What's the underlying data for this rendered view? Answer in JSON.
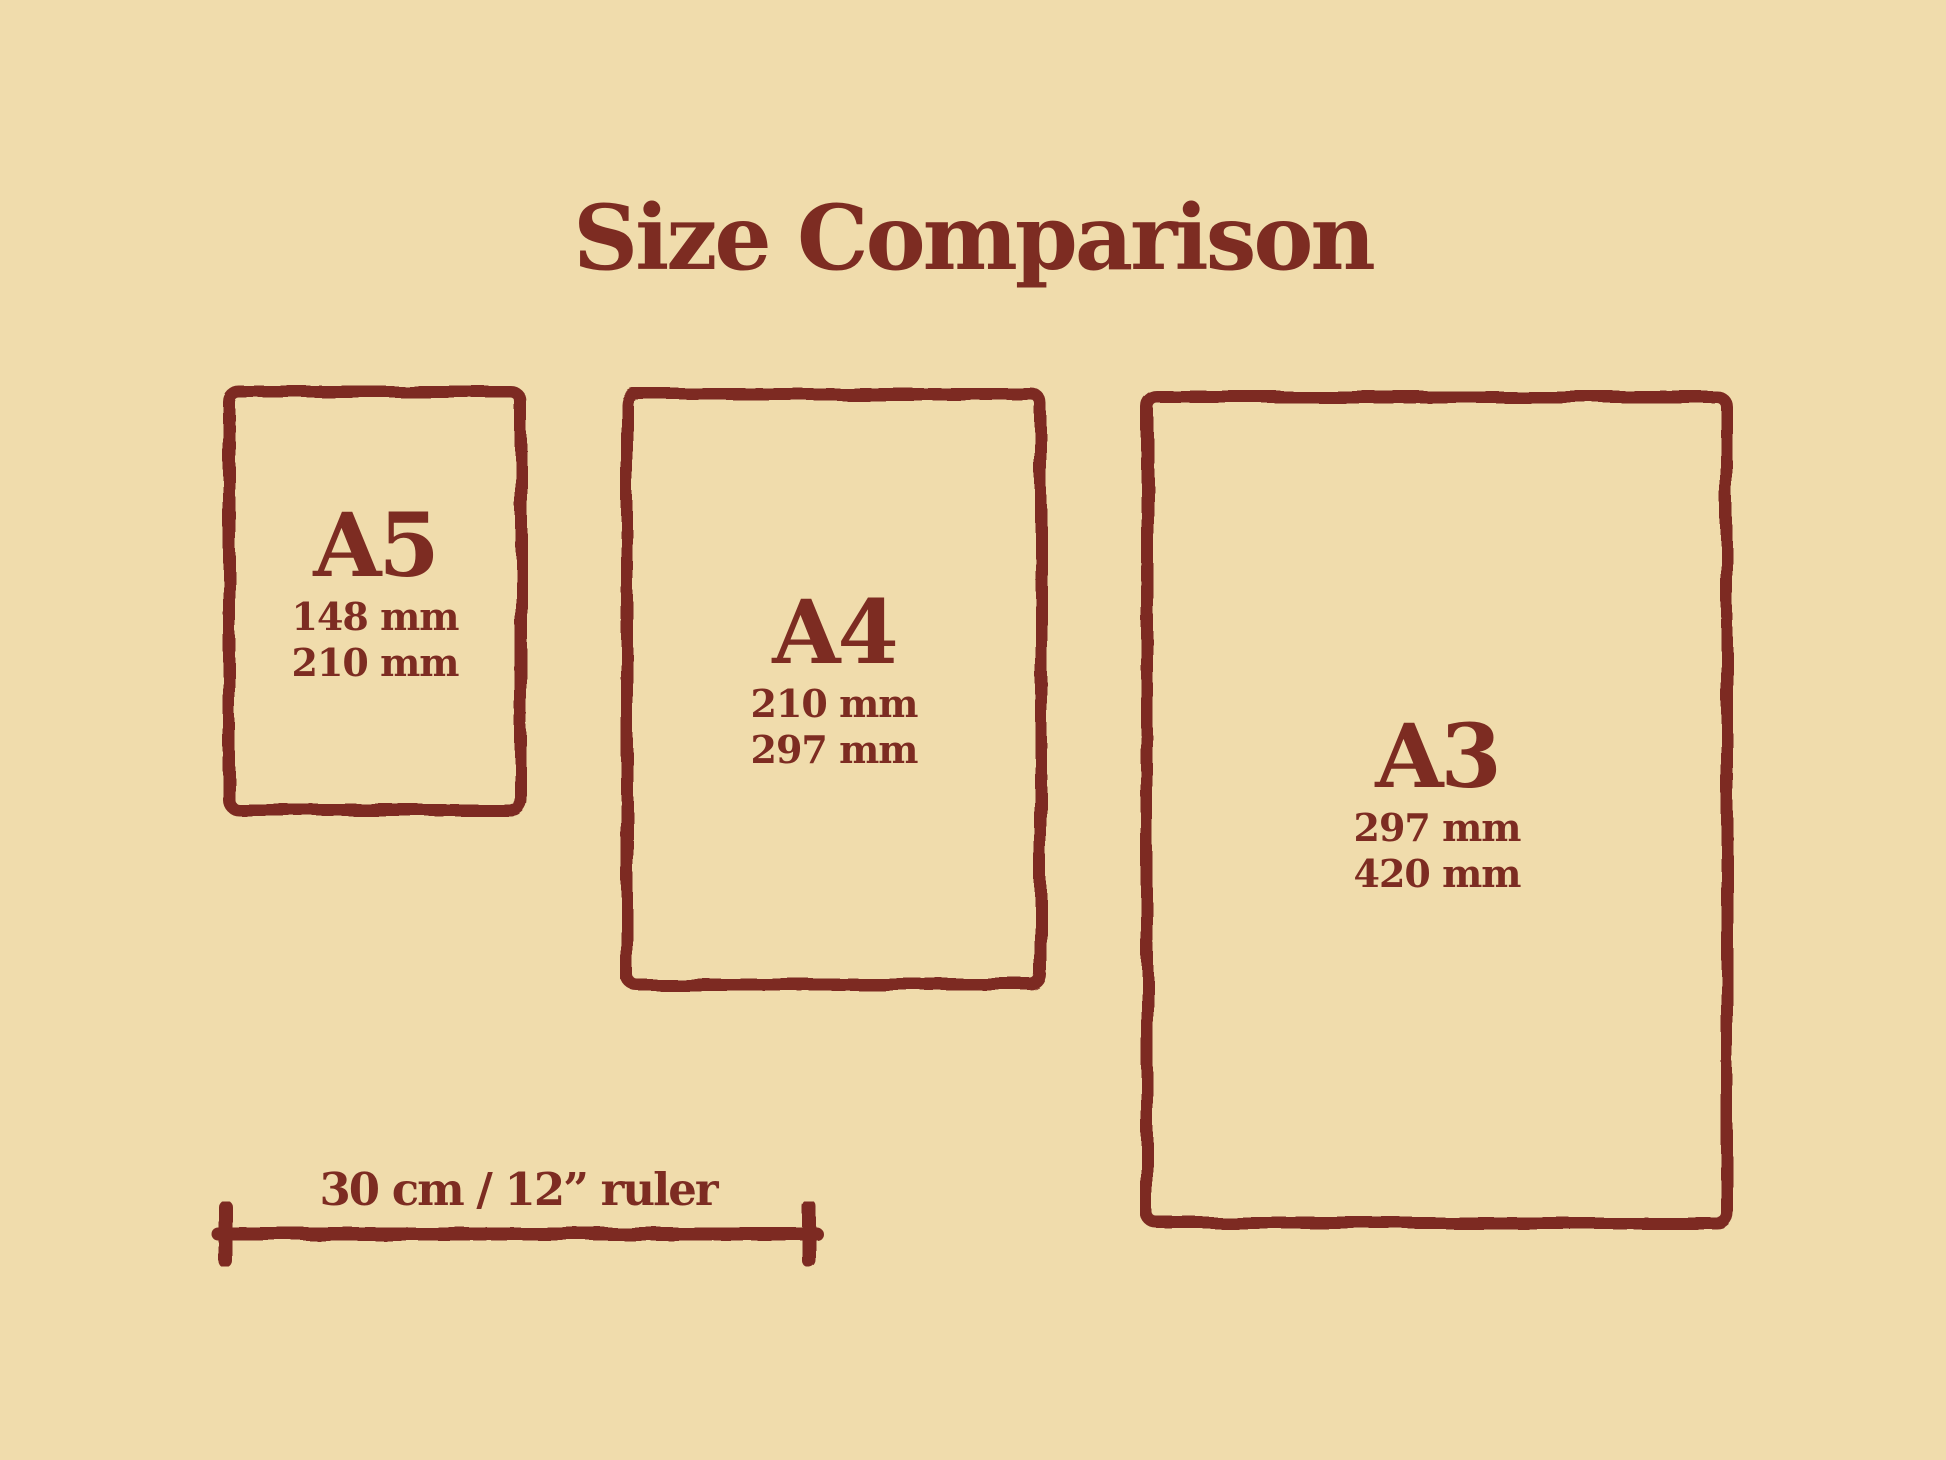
{
  "title": "Size Comparison",
  "colors": {
    "background": "#f0dcac",
    "ink": "#7d2c22"
  },
  "papers": [
    {
      "id": "a5",
      "label": "A5",
      "width_mm": "148 mm",
      "height_mm": "210 mm"
    },
    {
      "id": "a4",
      "label": "A4",
      "width_mm": "210 mm",
      "height_mm": "297 mm"
    },
    {
      "id": "a3",
      "label": "A3",
      "width_mm": "297 mm",
      "height_mm": "420 mm"
    }
  ],
  "ruler": {
    "label": "30 cm / 12” ruler"
  }
}
